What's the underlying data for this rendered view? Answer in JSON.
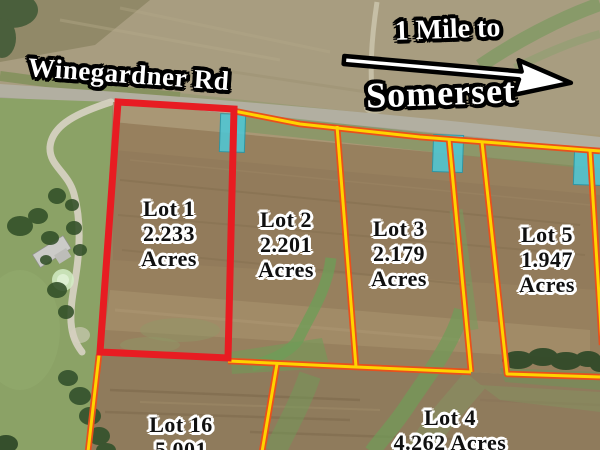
{
  "labels": {
    "road_name": "Winegardner Rd",
    "direction_line1": "1 Mile to",
    "direction_line2": "Somerset"
  },
  "lots": [
    {
      "name": "Lot 1",
      "line2": "2.233",
      "line3": "Acres",
      "acres": 2.233,
      "outline": "red"
    },
    {
      "name": "Lot 2",
      "line2": "2.201",
      "line3": "Acres",
      "acres": 2.201,
      "outline": "yellow"
    },
    {
      "name": "Lot 3",
      "line2": "2.179",
      "line3": "Acres",
      "acres": 2.179,
      "outline": "yellow"
    },
    {
      "name": "Lot 5",
      "line2": "1.947",
      "line3": "Acres",
      "acres": 1.947,
      "outline": "yellow"
    },
    {
      "name": "Lot 16",
      "line2": "5.001",
      "line3": "",
      "acres": 5.001,
      "outline": "yellow"
    },
    {
      "name": "Lot 4",
      "line2": "4.262 Acres",
      "line3": "",
      "acres": 4.262,
      "outline": "yellow"
    }
  ],
  "icons": {
    "direction_arrow": "arrow-right",
    "driveway_markers_count": 3
  },
  "colors": {
    "lot_boundary_yellow": "#ffd300",
    "lot_boundary_orange": "#e8501c",
    "highlight_red": "#e81c22",
    "driveway_marker_teal": "#4cc9d9",
    "label_text": "#101010",
    "label_halo": "#ffffff",
    "sign_text": "#ffffff",
    "sign_outline": "#000000"
  }
}
